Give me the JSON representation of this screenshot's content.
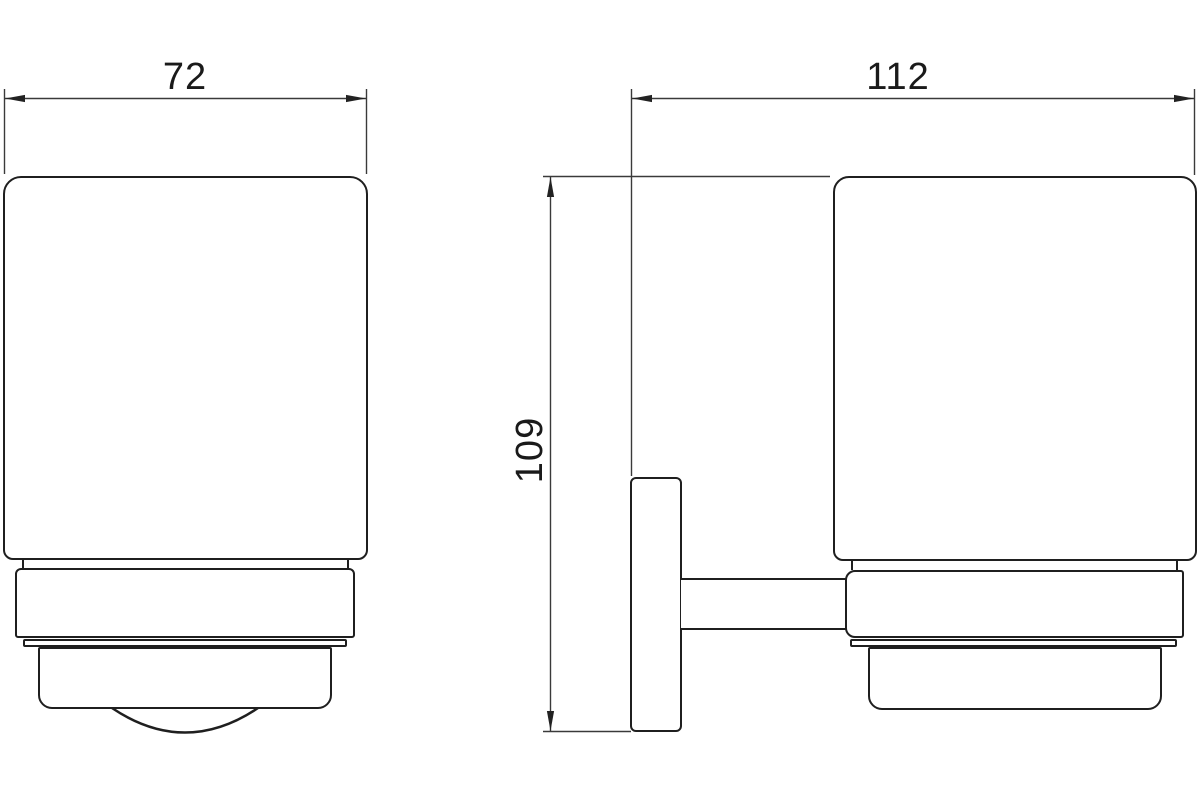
{
  "drawing": {
    "background_color": "#ffffff",
    "object_line_color": "#1f1f1f",
    "dimension_line_color": "#3a3a3a",
    "dimension_text_color": "#1a1a1a",
    "dimensions": {
      "front_width": "72",
      "side_width": "112",
      "side_height": "109"
    }
  }
}
